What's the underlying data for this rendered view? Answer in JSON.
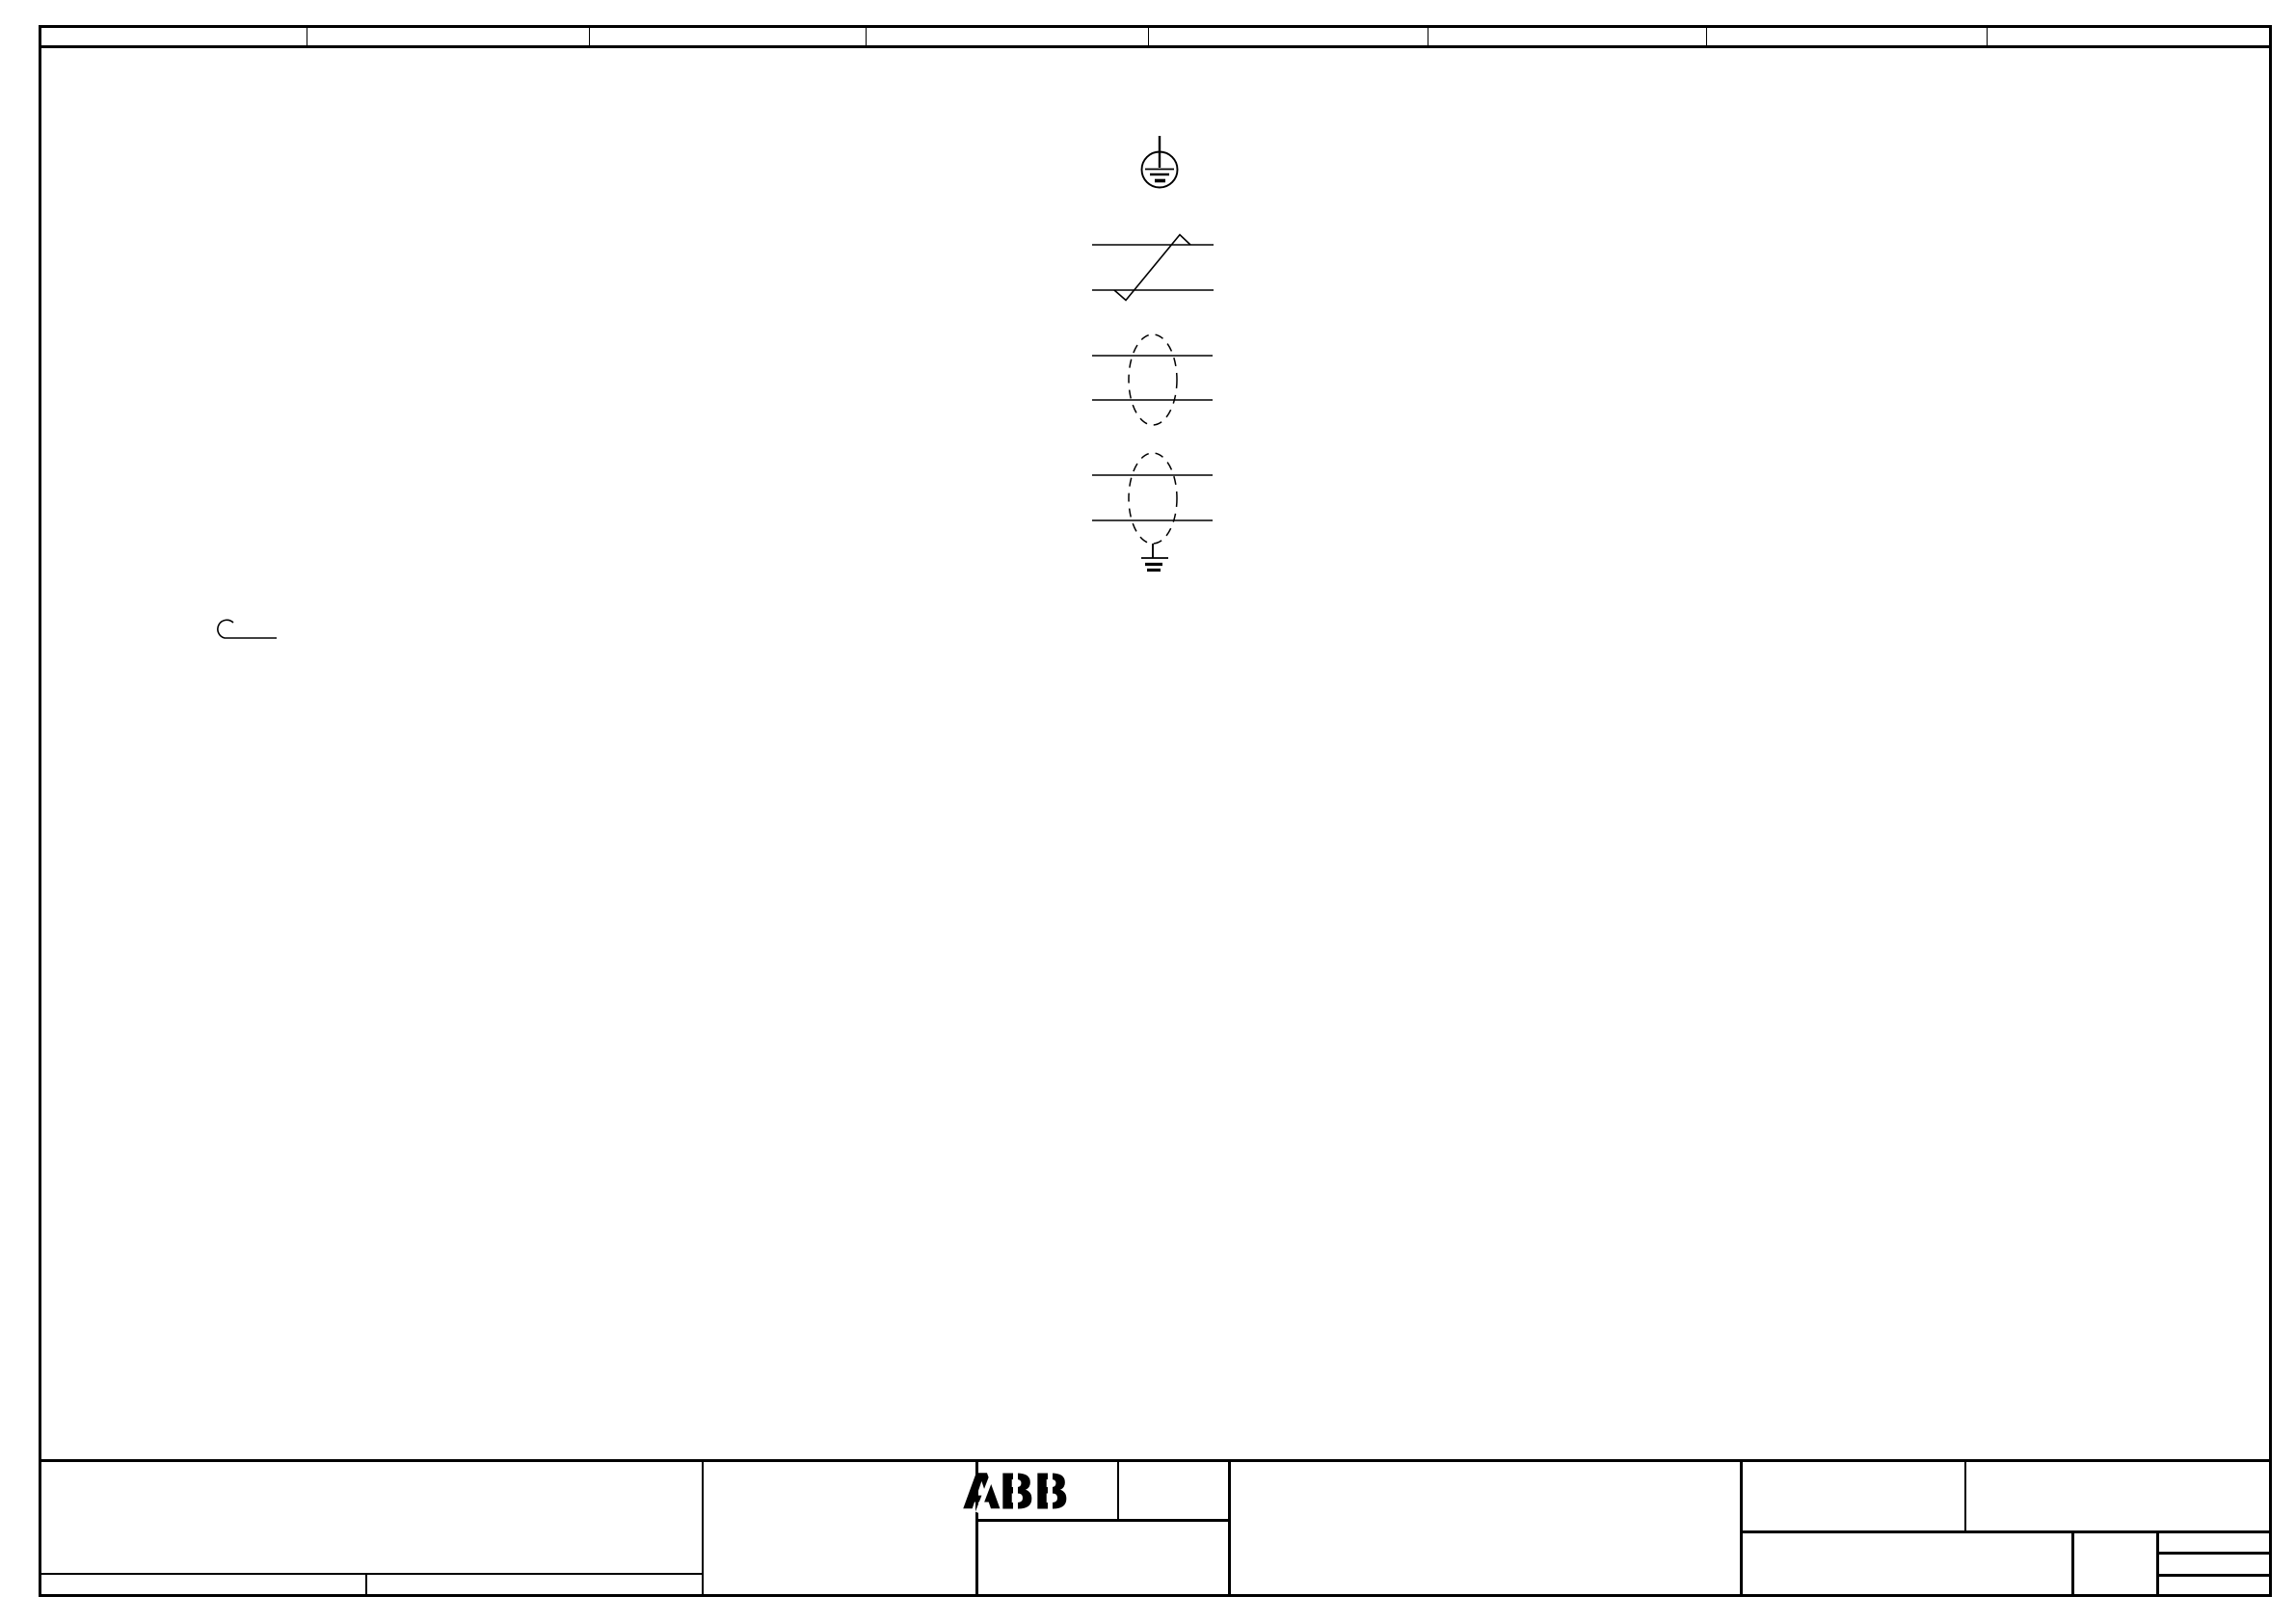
{
  "colors": {
    "ink": "#000000",
    "paper": "#ffffff"
  },
  "zone_header": {
    "cell_count": 8,
    "cells": [
      "",
      "",
      "",
      "",
      "",
      "",
      "",
      ""
    ]
  },
  "drawing_symbols": [
    {
      "name": "protective-earth-circle-icon",
      "meaning": "protective earth (ground) inside circle"
    },
    {
      "name": "conductor-transposition-icon",
      "meaning": "two conductors with crossing / transposition diagonal"
    },
    {
      "name": "shielded-pair-icon",
      "meaning": "two conductors inside dashed shield (screen)"
    },
    {
      "name": "shielded-pair-earthed-icon",
      "meaning": "two conductors inside dashed shield connected to earth"
    },
    {
      "name": "hook-icon",
      "meaning": "conductor end with open curl / hook"
    }
  ],
  "title_block": {
    "logo_text": "ABB",
    "fields": {
      "left_field": "",
      "left_sub_field_1": "",
      "left_sub_field_2": "",
      "middle_field": "",
      "logo_right_field": "",
      "below_logo_field": "",
      "center_field": "",
      "right_top_left_field": "",
      "right_top_right_field": "",
      "right_bottom_main_field": "",
      "right_bottom_small_field": "",
      "right_stack_row_1": "",
      "right_stack_row_2": "",
      "right_stack_row_3": ""
    }
  }
}
